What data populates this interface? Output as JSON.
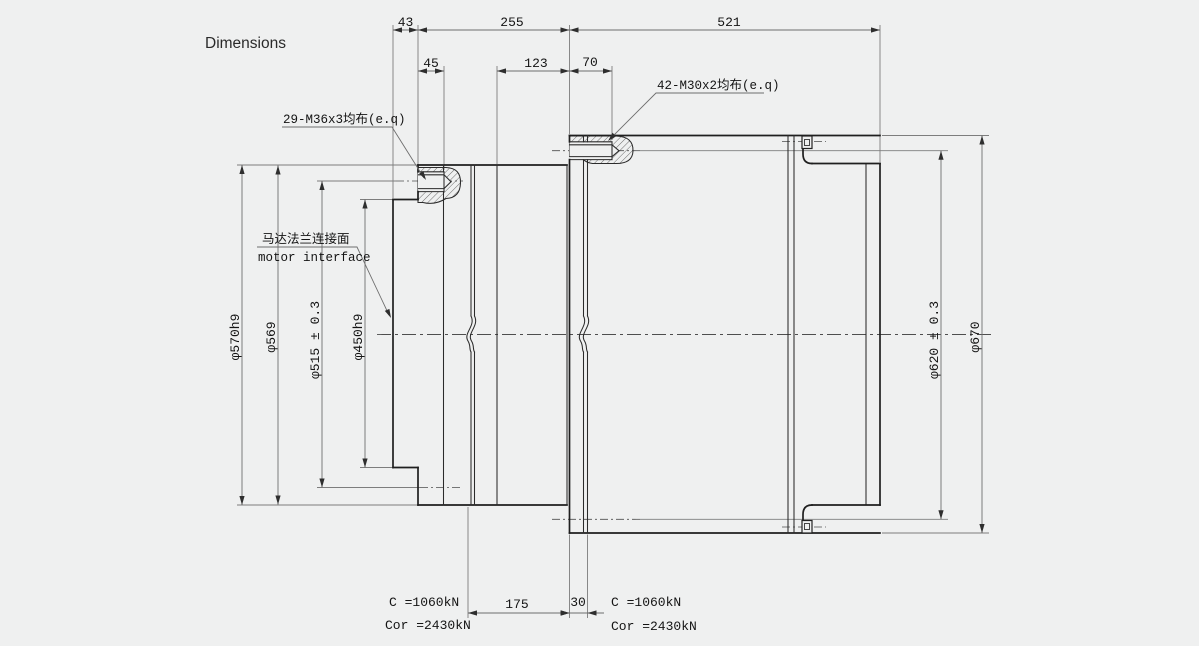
{
  "title": "Dimensions",
  "dims": {
    "top": {
      "d43": "43",
      "d255": "255",
      "d521": "521",
      "d45": "45",
      "d123": "123",
      "d70": "70"
    },
    "bottom": {
      "d175": "175",
      "d30": "30"
    },
    "left": {
      "d570": "φ570h9",
      "d569": "φ569",
      "d515": "φ515 ± 0.3",
      "d450": "φ450h9"
    },
    "right": {
      "d620": "φ620 ± 0.3",
      "d670": "φ670"
    }
  },
  "callouts": {
    "bolts_left": "29-M36x3均布(e.q)",
    "bolts_right": "42-M30x2均布(e.q)",
    "motor_cn": "马达法兰连接面",
    "motor_en": "motor interface"
  },
  "ratings": {
    "left": {
      "c": "C =1060kN",
      "cor": "Cor =2430kN"
    },
    "right": {
      "c": "C =1060kN",
      "cor": "Cor =2430kN"
    }
  },
  "colors": {
    "background": "#eff0f0",
    "outline": "#1f1f1f",
    "dimension": "#6e6e6e"
  }
}
